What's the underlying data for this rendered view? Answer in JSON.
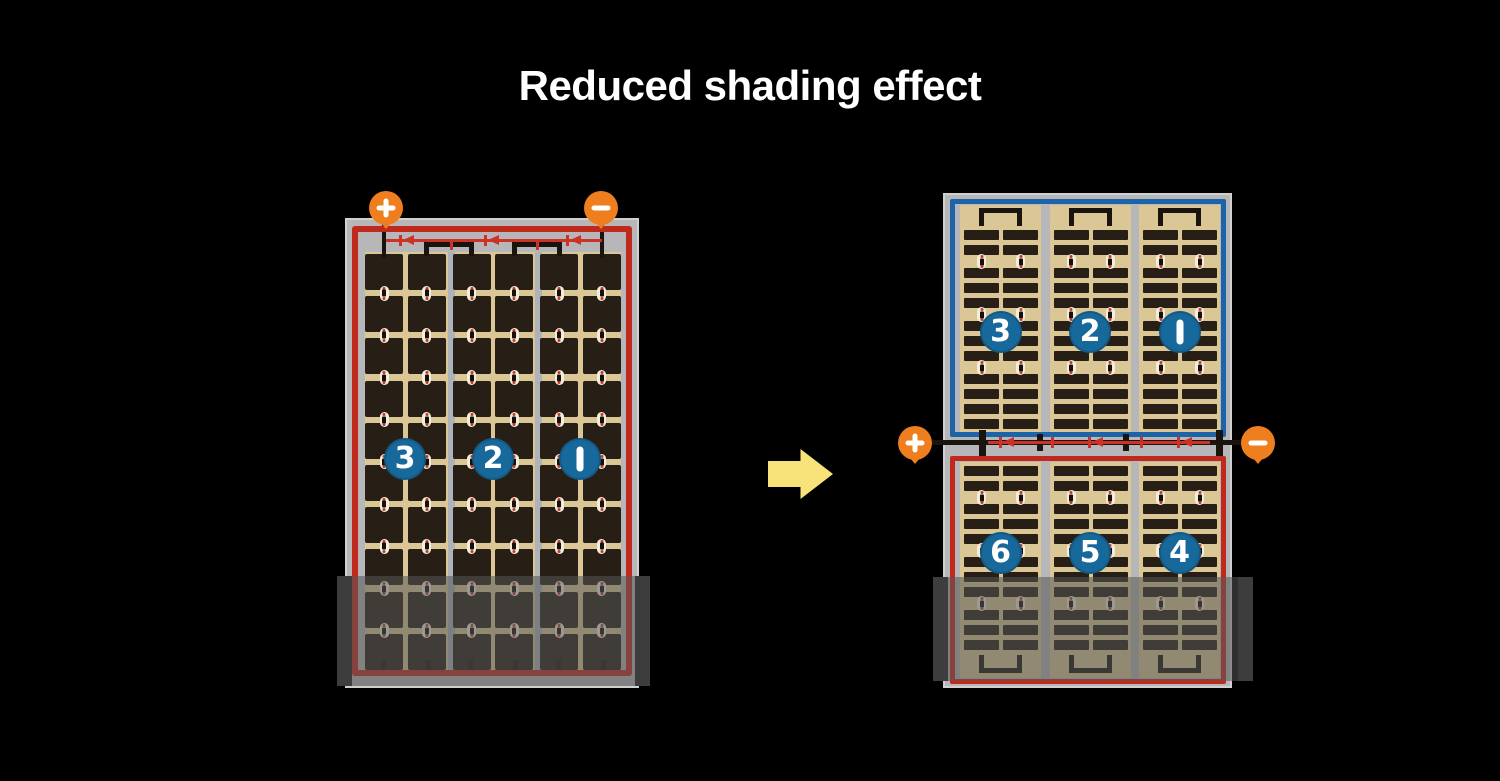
{
  "title": "Reduced shading effect",
  "colors": {
    "background": "#000000",
    "panel_frame": "#b7b7b9",
    "cell_field": "#dbc795",
    "cell_dark": "#271e16",
    "circuit_red": "#c02a1d",
    "diode_red": "#cc3227",
    "half_border_blue": "#1d63a8",
    "string_badge_blue": "#17699c",
    "terminal_orange": "#ef7f1e",
    "arrow_yellow": "#f7e37a"
  },
  "left_panel": {
    "cell_rows": 10,
    "cell_columns": 6,
    "bypass_diodes": 3,
    "terminals": [
      {
        "symbol": "+",
        "polarity": "positive"
      },
      {
        "symbol": "−",
        "polarity": "negative"
      }
    ],
    "strings": [
      {
        "label": "3"
      },
      {
        "label": "2"
      },
      {
        "label": "1"
      }
    ],
    "shaded_bottom": true
  },
  "right_panel": {
    "bypass_diodes": 3,
    "terminals": [
      {
        "symbol": "+",
        "polarity": "positive"
      },
      {
        "symbol": "−",
        "polarity": "negative"
      }
    ],
    "top_half": {
      "strings": [
        {
          "label": "3"
        },
        {
          "label": "2"
        },
        {
          "label": "1"
        }
      ]
    },
    "bottom_half": {
      "strings": [
        {
          "label": "6"
        },
        {
          "label": "5"
        },
        {
          "label": "4"
        }
      ]
    },
    "shaded_bottom": true
  }
}
